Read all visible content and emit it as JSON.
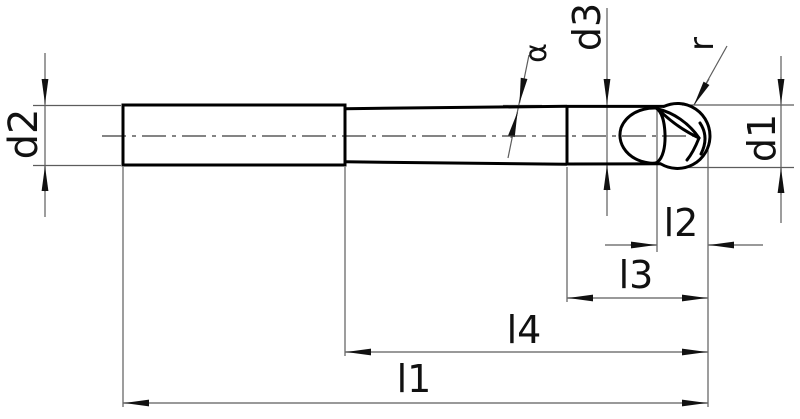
{
  "diagram": {
    "description": "Dimensioned engineering line drawing of a ball-nose end mill cutter with tapered neck",
    "background": "#ffffff",
    "outline_color": "#000000",
    "dimension_line_color": "#5c5c5c",
    "labels": {
      "d1": "d1",
      "d2": "d2",
      "d3": "d3",
      "r": "r",
      "alpha": "α",
      "l1": "l1",
      "l2": "l2",
      "l3": "l3",
      "l4": "l4"
    }
  }
}
